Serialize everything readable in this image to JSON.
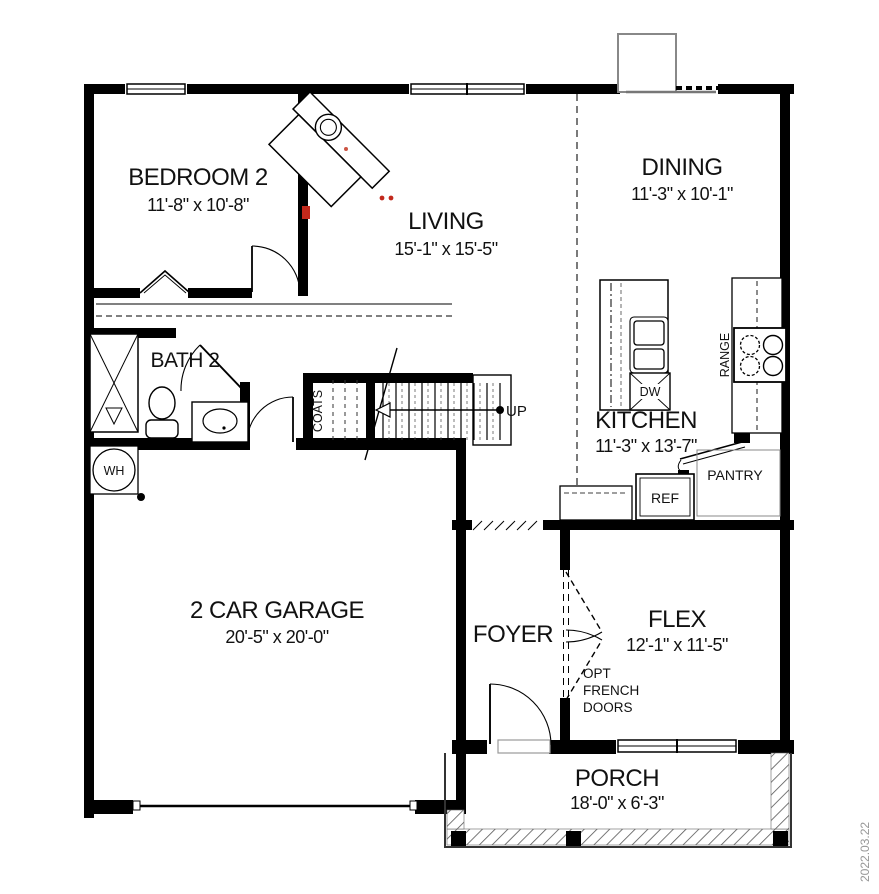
{
  "rooms": {
    "bedroom2": {
      "name": "BEDROOM 2",
      "dims": "11'-8\" x 10'-8\""
    },
    "living": {
      "name": "LIVING",
      "dims": "15'-1\" x 15'-5\""
    },
    "dining": {
      "name": "DINING",
      "dims": "11'-3\" x 10'-1\""
    },
    "bath2": {
      "name": "BATH 2"
    },
    "kitchen": {
      "name": "KITCHEN",
      "dims": "11'-3\" x 13'-7\""
    },
    "garage": {
      "name": "2 CAR GARAGE",
      "dims": "20'-5\" x 20'-0\""
    },
    "foyer": {
      "name": "FOYER"
    },
    "flex": {
      "name": "FLEX",
      "dims": "12'-1\" x 11'-5\""
    },
    "porch": {
      "name": "PORCH",
      "dims": "18'-0\" x 6'-3\""
    }
  },
  "labels": {
    "water_heater": "WH",
    "coats": "COATS",
    "stairs_up": "UP",
    "dishwasher": "DW",
    "range": "RANGE",
    "pantry": "PANTRY",
    "refrigerator": "REF",
    "opt_french_doors": [
      "OPT",
      "FRENCH",
      "DOORS"
    ],
    "date_stamp": "2022.03.22"
  },
  "colors": {
    "wall": "#000000",
    "fixture_line": "#222222",
    "chimney_gray": "#888888",
    "date_gray": "#979797",
    "markup_red": "#c2291c",
    "background": "#ffffff"
  }
}
